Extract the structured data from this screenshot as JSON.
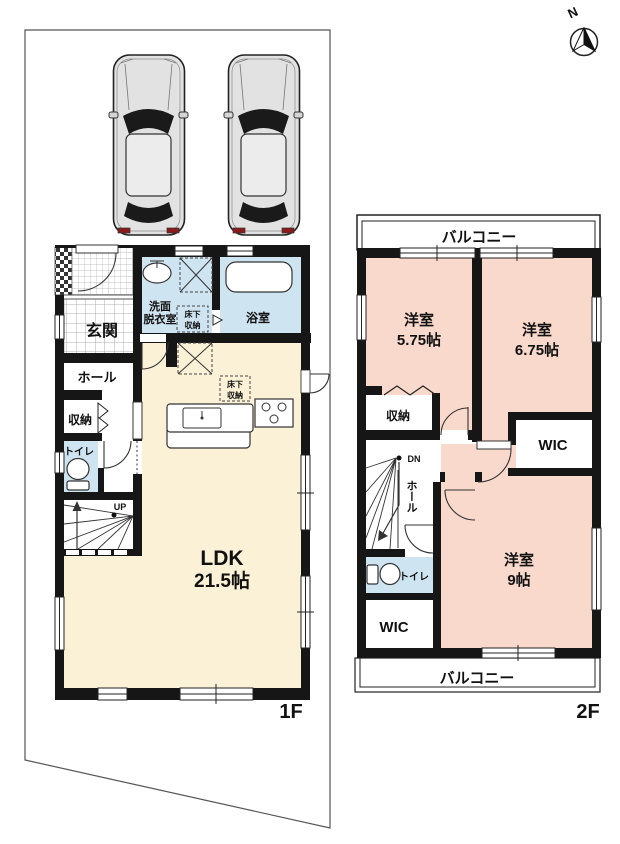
{
  "compass": {
    "north_label": "N"
  },
  "floor1": {
    "label": "1F",
    "genkan": "玄関",
    "hall": "ホール",
    "storage": "収納",
    "toilet": "トイレ",
    "washroom_l1": "洗面",
    "washroom_l2": "脱衣室",
    "bathroom": "浴室",
    "underfloor_a_l1": "床下",
    "underfloor_a_l2": "収納",
    "underfloor_b_l1": "床下",
    "underfloor_b_l2": "収納",
    "ldk": "LDK",
    "ldk_size": "21.5帖",
    "up": "UP"
  },
  "floor2": {
    "label": "2F",
    "balcony_top": "バルコニー",
    "balcony_bottom": "バルコニー",
    "bedroom1": "洋室",
    "bedroom1_size": "5.75帖",
    "bedroom2": "洋室",
    "bedroom2_size": "6.75帖",
    "bedroom3": "洋室",
    "bedroom3_size": "9帖",
    "storage": "収納",
    "wic_east": "WIC",
    "wic_south": "WIC",
    "hall": "ホール",
    "toilet": "トイレ",
    "down": "DN"
  },
  "colors": {
    "wall": "#161616",
    "ldk_floor": "#faf1d6",
    "bedroom_floor": "#f9d9cc",
    "wet_area_floor": "#cfe4f1",
    "background": "#ffffff"
  }
}
